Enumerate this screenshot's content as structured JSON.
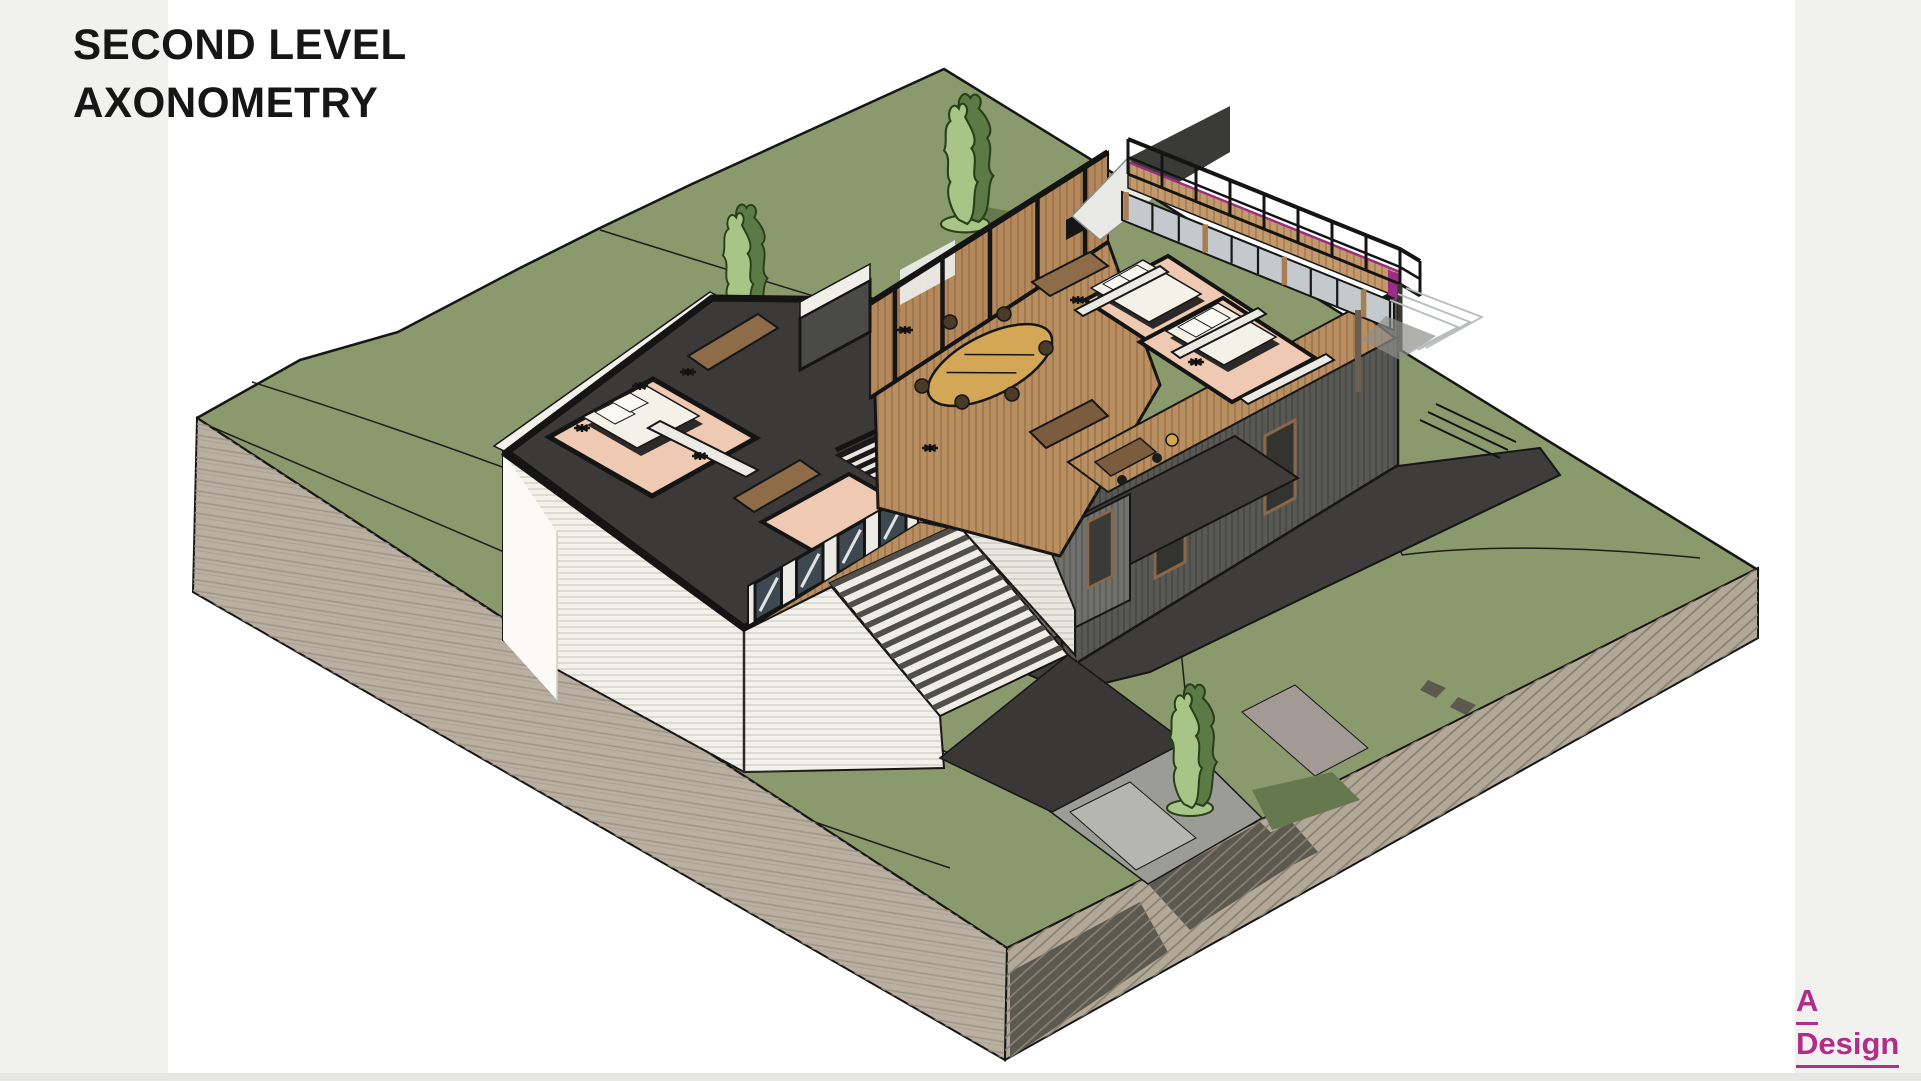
{
  "header": {
    "line1": "SECOND LEVEL",
    "line2": "AXONOMETRY"
  },
  "logo": {
    "line1": "A",
    "line2": "Design"
  },
  "palette": {
    "page_bg": "#ffffff",
    "margin_strip": "#f1f1ef",
    "bottom_strip": "#e7e7e5",
    "title_color": "#161616",
    "logo_color": "#b02d8c",
    "grass": "#8b9a6c",
    "contour_line": "#1c1c1a",
    "earth_left": "#b9b0a1",
    "earth_right": "#b2a898",
    "earth_dark_patch": "#5c5a50",
    "slab_dark": "#3e3d3b",
    "ramp_dark": "#393836",
    "path_grey": "#9c9c96",
    "path_light": "#b6b6b0",
    "path_mauve": "#a39a95",
    "wall_white": "#f3f1eb",
    "wall_white_bright": "#fbfaf7",
    "stair_tread_light": "#efede5",
    "stair_tread_dark": "#514f49",
    "floor_dark": "#3b3a38",
    "wall_cut_black": "#141414",
    "pink_floor": "#efc9b2",
    "wood_floor": "#b98e60",
    "wood_wall": "#b5885c",
    "wood_fascia": "#c49a6c",
    "table_tan": "#d3a755",
    "sofa_brown": "#8f6c48",
    "furniture_wood": "#7c5c3e",
    "bed_white": "#f4f1e8",
    "bed_base": "#2c2a28",
    "glass_dark": "#3d4850",
    "glass_light": "#c3c9cc",
    "wall_grey_se": "#585854",
    "wall_grey_lower": "#70706c",
    "hall_grey": "#514f4b",
    "partition_white": "#eceae4",
    "railing_black": "#141414",
    "accent_magenta": "#9b2d86",
    "tree_light": "#a9c487",
    "tree_dark": "#5c7a45",
    "tree_shadow": "#66784e",
    "ghost_grey": "#b9bcbe",
    "canopy_white": "#e9e9e5"
  }
}
